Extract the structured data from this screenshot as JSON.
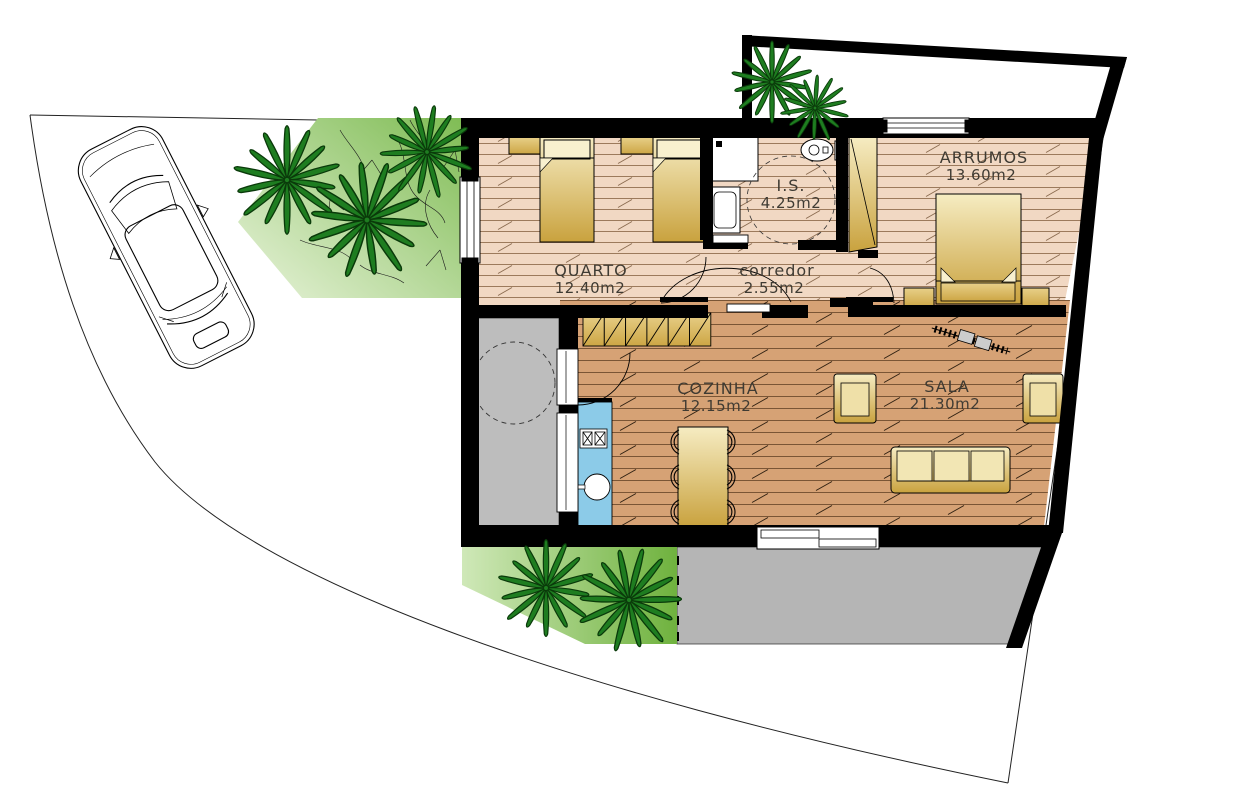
{
  "document": {
    "type": "architectural-floor-plan",
    "language": "pt"
  },
  "rooms": [
    {
      "id": "quarto",
      "label": "QUARTO",
      "area": "12.40m2"
    },
    {
      "id": "is",
      "label": "I.S.",
      "area": "4.25m2"
    },
    {
      "id": "corredor",
      "label": "corredor",
      "area": "2.55m2"
    },
    {
      "id": "arrumos",
      "label": "ARRUMOS",
      "area": "13.60m2"
    },
    {
      "id": "cozinha",
      "label": "COZINHA",
      "area": "12.15m2"
    },
    {
      "id": "sala",
      "label": "SALA",
      "area": "21.30m2"
    }
  ],
  "site": {
    "vehicle": "car-top-view",
    "palm_trees": {
      "front_garden": 3,
      "courtyard": 2,
      "back_garden": 2
    }
  },
  "colors": {
    "wall": "#000000",
    "floor_bedrooms": "#F1D8C3",
    "floor_lines_bedrooms": "#9c7a5c",
    "floor_living": "#D6A275",
    "floor_lines_living": "#7a5535",
    "furniture_light": "#F6ECC2",
    "furniture_dark": "#C9A23E",
    "cabinet_light": "#E8D089",
    "cabinet_dark": "#CDA645",
    "counter_blue": "#8CCBE8",
    "patio_gray": "#BDBDBD",
    "terrace_gray": "#B5B5B5",
    "garden_light": "#E8F3DA",
    "garden_dark": "#7FBC54",
    "garden2_light": "#CFE8B8",
    "garden2_dark": "#6FB23E",
    "palm_green": "#1E7D20"
  }
}
